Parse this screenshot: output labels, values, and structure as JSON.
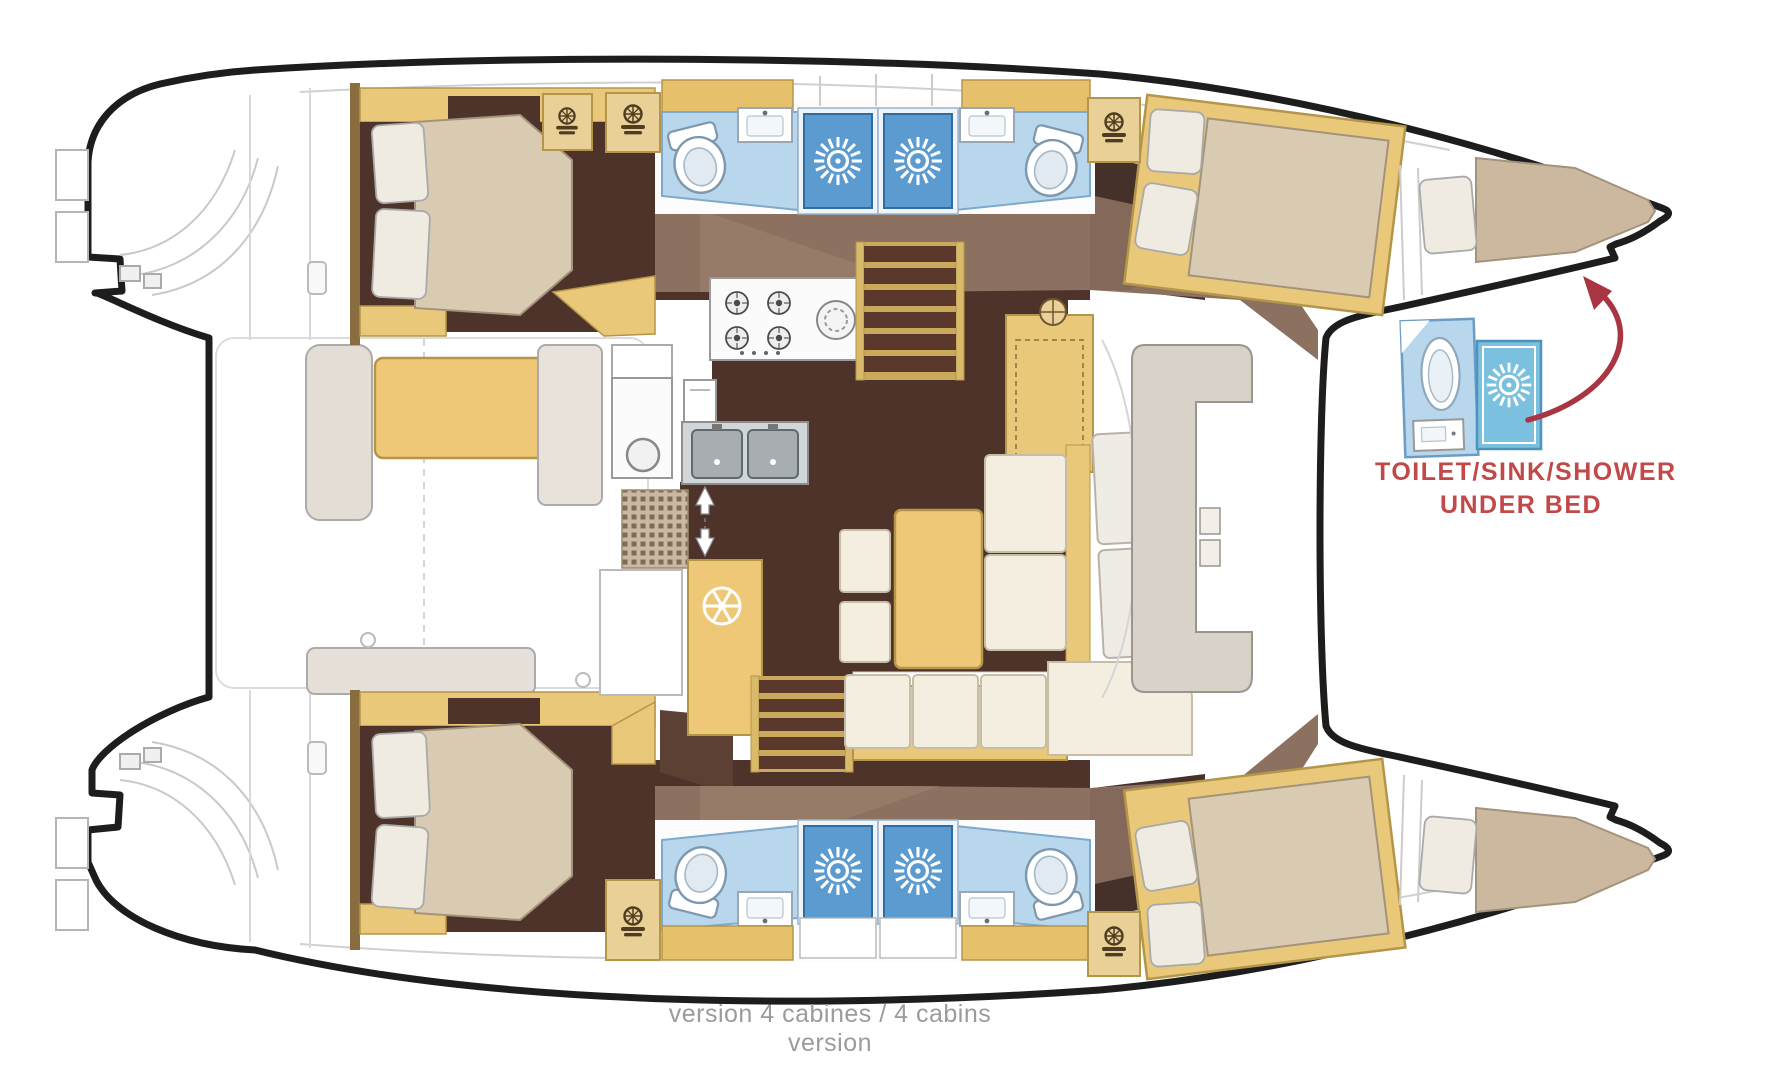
{
  "annotation": {
    "line1": "TOILET/SINK/SHOWER",
    "line2": "UNDER BED",
    "color": "#c14949"
  },
  "caption": {
    "text": "version 4 cabines / 4 cabins version",
    "color": "#9b9b9b"
  },
  "palette": {
    "hull_outline": "#1d1d1d",
    "wood_tan": "#eac879",
    "wood_tan_light": "#e9d096",
    "wood_border": "#b4964a",
    "floor_dark_brown": "#4e332b",
    "walkway_brown": "#8d7160",
    "mattress_beige": "#d9cbb2",
    "bow_mattress_beige": "#cbb89e",
    "pillow_white": "#efebe1",
    "bathroom_floor_blue": "#b9d7ec",
    "shower_blue": "#5b9bd0",
    "inset_shower_blue": "#7cc0e0",
    "sofa_cream": "#f3eee0",
    "cockpit_bench_gray": "#d9d2c9",
    "label_red": "#c14949",
    "arrow_red": "#a93442",
    "caption_gray": "#9b9b9b"
  },
  "icons": {
    "shower_head": "sunburst-icon",
    "helm_wheel": "ship-wheel-icon",
    "cabinet_emblem": "helm-emblem-icon",
    "companionway": "up-down-arrow-icon",
    "callout": "curved-arrow-icon"
  }
}
